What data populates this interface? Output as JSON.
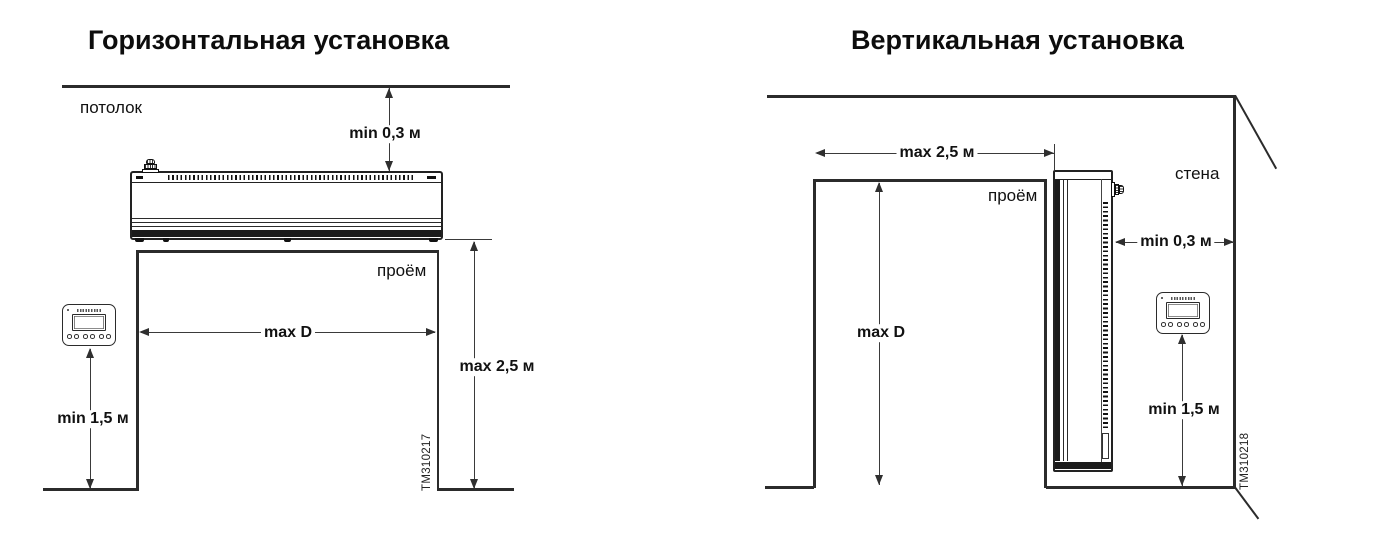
{
  "colors": {
    "line": "#2b2b2b",
    "dim_line": "#3a3a3a",
    "text": "#111111",
    "background": "#ffffff"
  },
  "left": {
    "title": "Горизонтальная установка",
    "ceiling_label": "потолок",
    "opening_label": "проём",
    "dims": {
      "ceiling_gap": "min 0,3 м",
      "opening_width": "max D",
      "mount_height": "max 2,5 м",
      "controller_height": "min 1,5 м"
    },
    "drawing_code": "TM310217"
  },
  "right": {
    "title": "Вертикальная установка",
    "wall_label": "стена",
    "opening_label": "проём",
    "dims": {
      "opening_width": "max 2,5 м",
      "opening_height": "max D",
      "wall_gap": "min 0,3 м",
      "controller_height": "min 1,5 м"
    },
    "drawing_code": "TM310218"
  }
}
